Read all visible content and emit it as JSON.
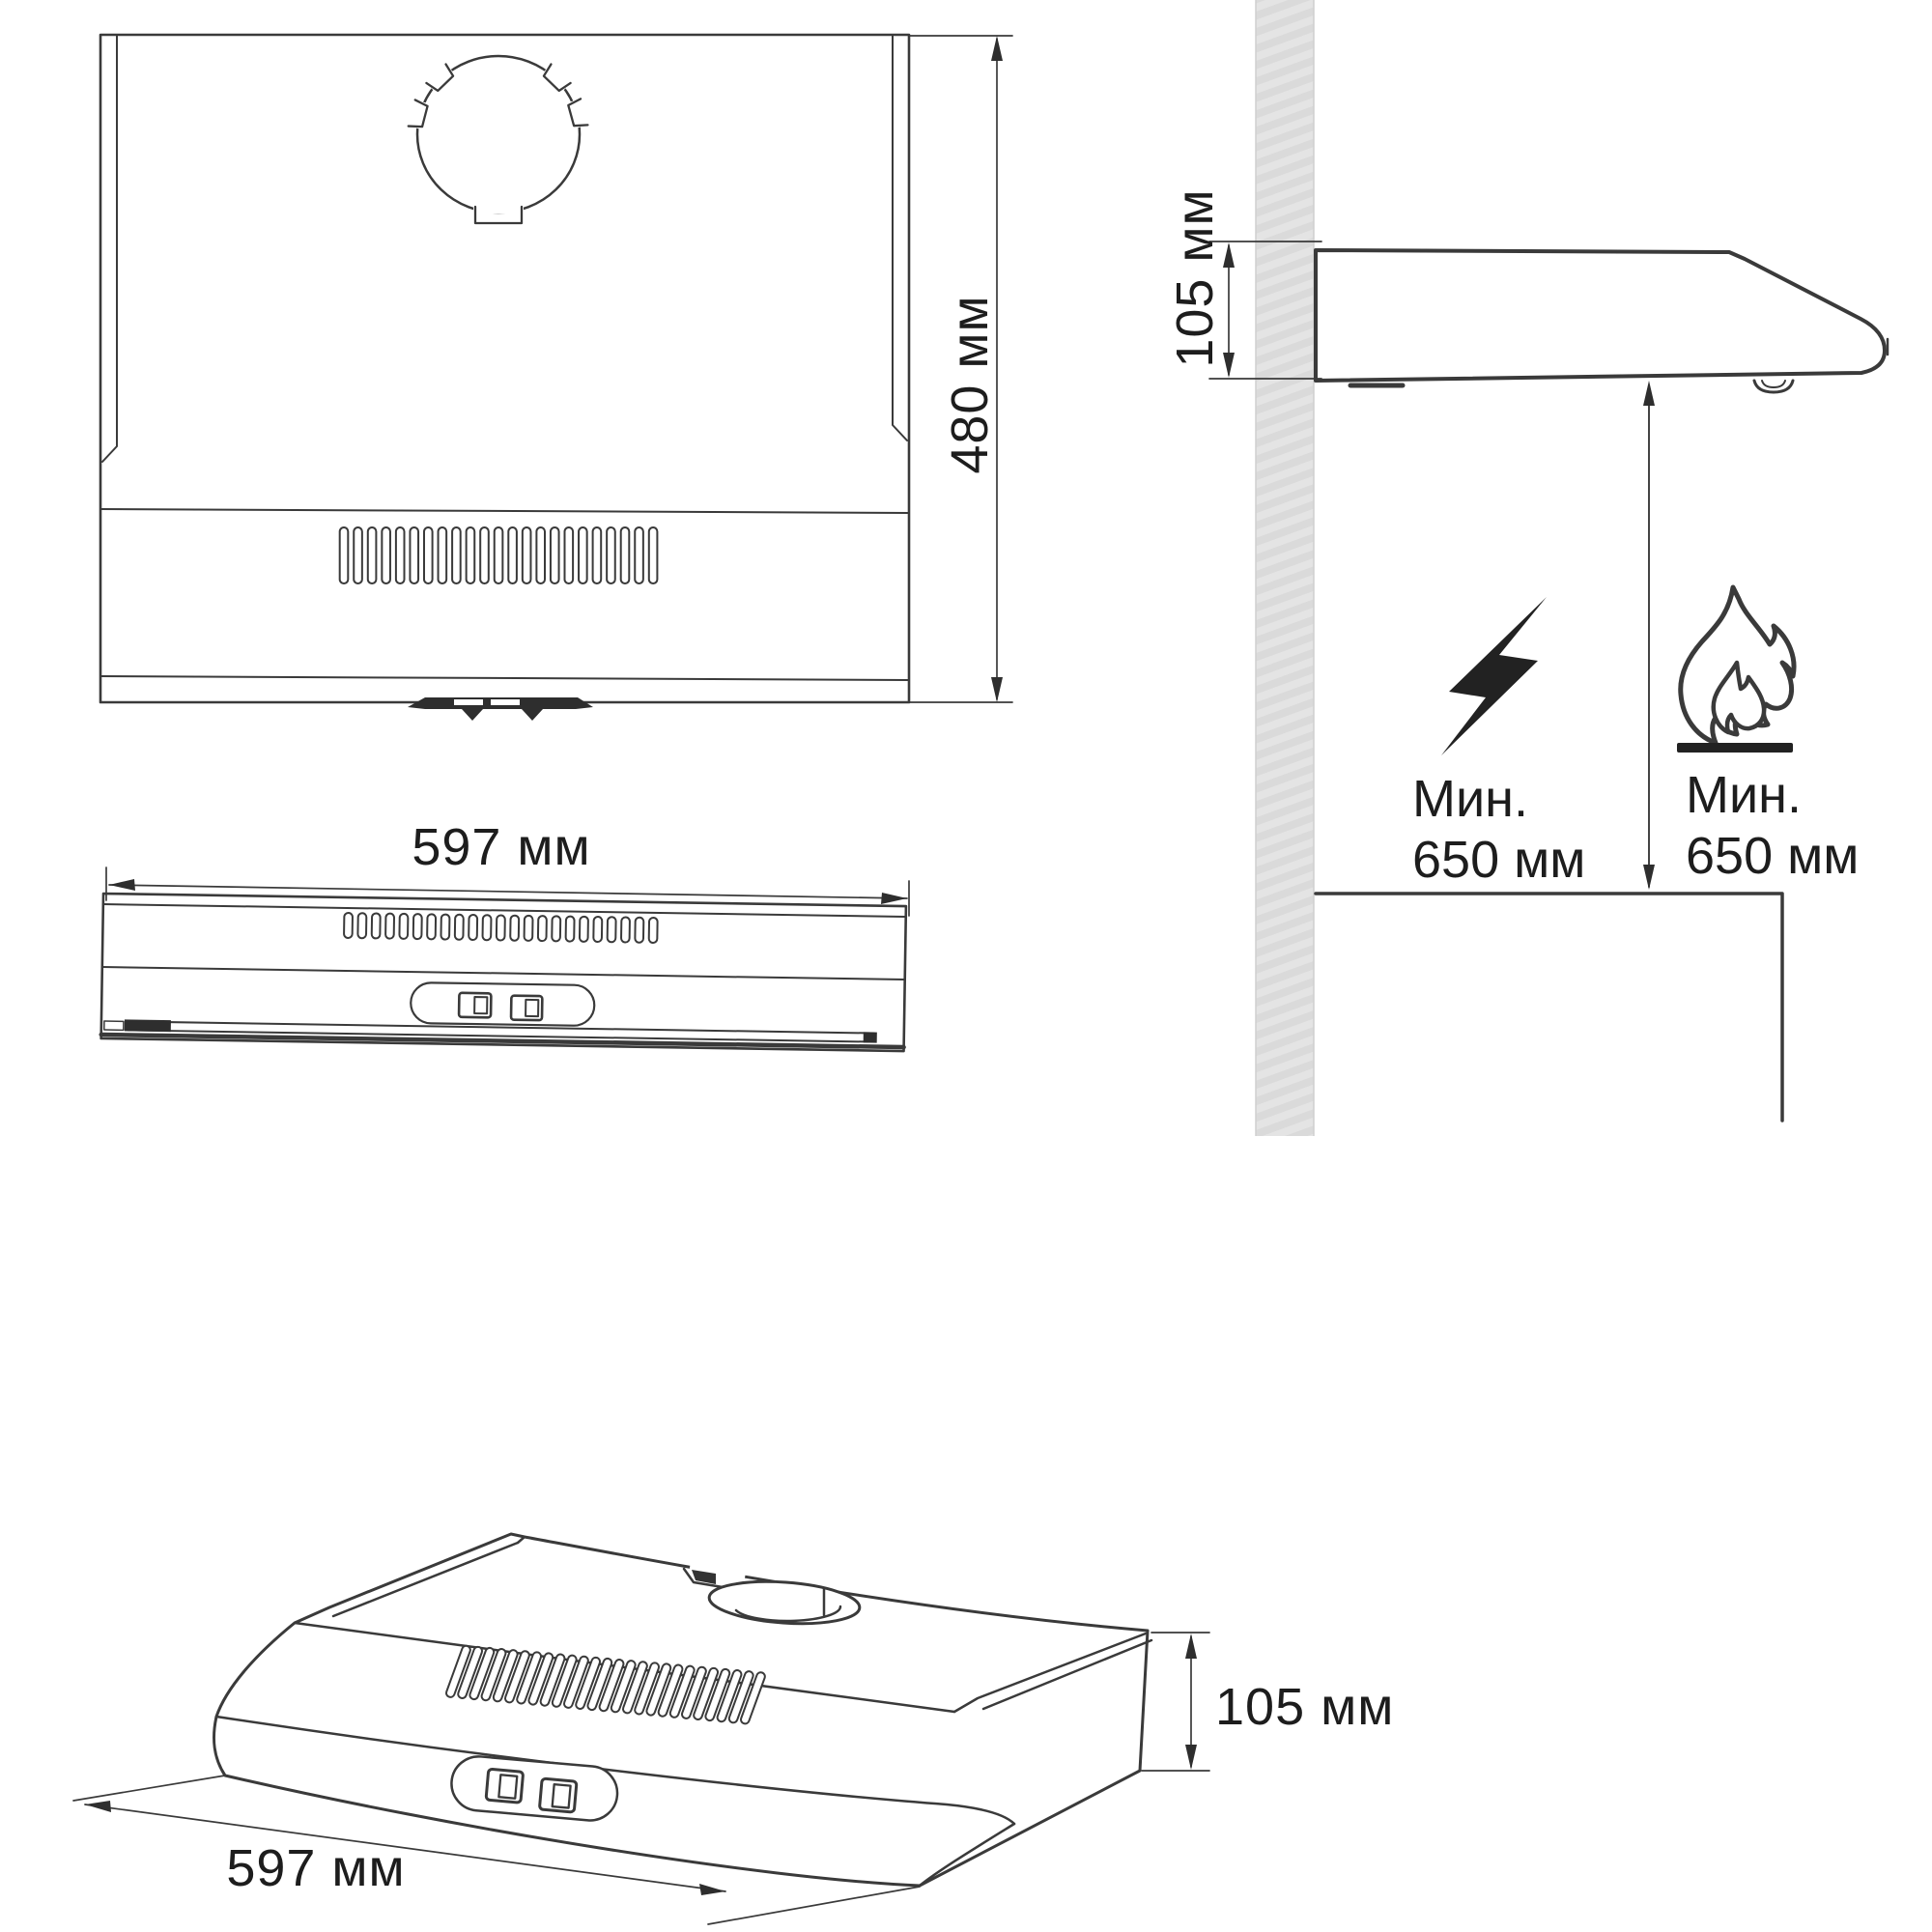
{
  "page": {
    "background": "#ffffff",
    "ink_color": "#3a3a3a",
    "text_color": "#1d1d1d",
    "wall_fill": "#dadada"
  },
  "views": {
    "top": {
      "height_dim_label": "480 мм"
    },
    "front": {
      "width_dim_label": "597 мм"
    },
    "side": {
      "depth_dim_label": "105 мм",
      "electric_clearance": {
        "icon": "lightning-bolt-icon",
        "line1": "Мин.",
        "line2": "650 мм"
      },
      "gas_clearance": {
        "icon": "open-flame-icon",
        "line1": "Мин.",
        "line2": "650 мм"
      }
    },
    "perspective": {
      "width_dim_label": "597 мм",
      "height_dim_label": "105 мм"
    }
  }
}
